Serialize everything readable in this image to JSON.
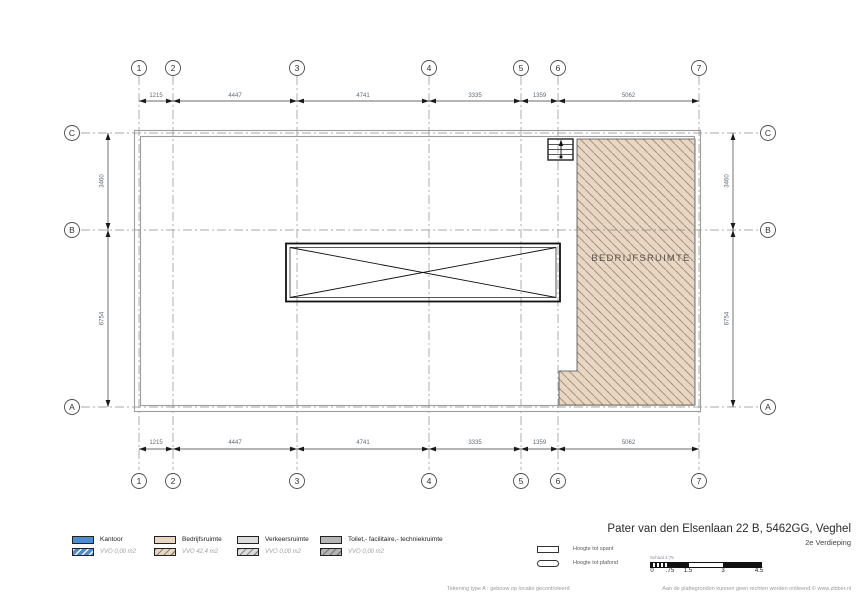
{
  "drawing": {
    "grid_columns": [
      "1",
      "2",
      "3",
      "4",
      "5",
      "6",
      "7"
    ],
    "grid_rows": [
      "C",
      "B",
      "A"
    ],
    "dims_horizontal": [
      "1215",
      "4447",
      "4741",
      "3335",
      "1359",
      "5062"
    ],
    "dims_vertical": [
      "3460",
      "6754"
    ],
    "room_label": "BEDRIJFSRUIMTE",
    "colors": {
      "bedrijfsruimte_fill": "#e9d7c3",
      "hatch_line": "#a6937f"
    }
  },
  "legend": {
    "items": [
      {
        "label": "Kantoor",
        "vvo": "VVO 0,00 m2",
        "color": "#4a8dd2"
      },
      {
        "label": "Bedrijfsruimte",
        "vvo": "VVO 42,4 m2",
        "color": "#e9d7c3"
      },
      {
        "label": "Verkeersruimte",
        "vvo": "VVO 0,00 m2",
        "color": "#dcdcdc"
      },
      {
        "label": "Toilet,- facilitaire,- techniekruimte",
        "vvo": "VVO 0,00 m2",
        "color": "#b5b5b5"
      }
    ],
    "heights": [
      {
        "label": "Hoogte tot spant"
      },
      {
        "label": "Hoogte tot plafond"
      }
    ]
  },
  "title_block": {
    "address": "Pater van den Elsenlaan 22 B, 5462GG, Veghel",
    "floor": "2e Verdieping",
    "scale_label": "Schaal 1:75",
    "scale_ticks": [
      "0",
      ".75",
      "1.5",
      "3",
      "4.5"
    ]
  },
  "footer": {
    "left": "Tekening type A : gebouw op locatie gecontroleerd",
    "right": "Aan de plattegronden kunnen geen rechten worden ontleend.© www.zibber.nl"
  }
}
